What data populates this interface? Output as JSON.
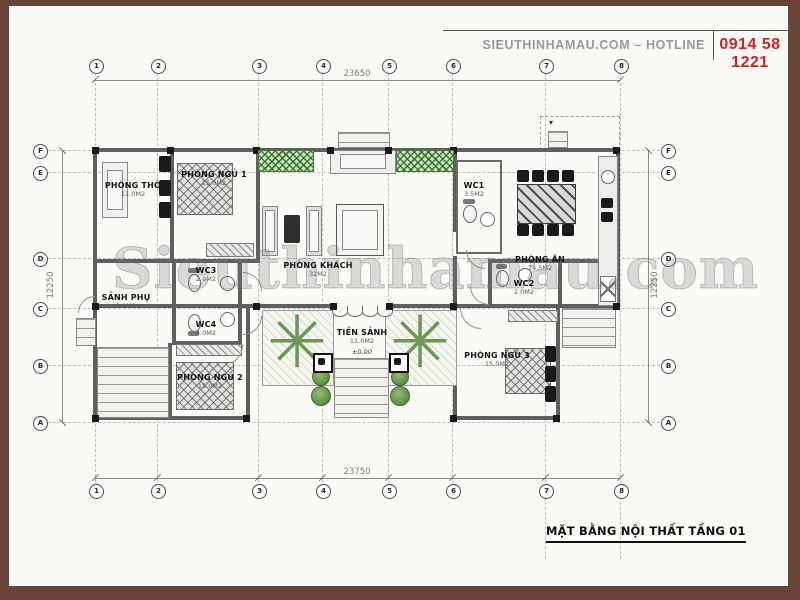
{
  "header": {
    "site": "SIEUTHINHAMAU.COM – HOTLINE",
    "phone": "0914 58 1221"
  },
  "title_block": {
    "drawing_title": "MẶT BẰNG NỘI THẤT TẦNG 01"
  },
  "watermark": "Sieuthinhamau.com",
  "dimensions": {
    "top": "23650",
    "bottom": "23750",
    "left": "12250",
    "right": "12250"
  },
  "grid": {
    "cols": [
      "1",
      "2",
      "3",
      "4",
      "5",
      "6",
      "7",
      "8"
    ],
    "rows": [
      "F",
      "E",
      "D",
      "C",
      "B",
      "A"
    ]
  },
  "rooms": [
    {
      "name": "PHÒNG THỜ",
      "area": "11.0M2"
    },
    {
      "name": "PHÒNG NGỦ 1",
      "area": "15.0M2"
    },
    {
      "name": "PHÒNG KHÁCH",
      "area": "32M2"
    },
    {
      "name": "WC1",
      "area": "3.5M2"
    },
    {
      "name": "PHÒNG ĂN",
      "area": "24.5M2"
    },
    {
      "name": "SẢNH PHỤ",
      "area": "9.0M2"
    },
    {
      "name": "WC3",
      "area": "2.0M2"
    },
    {
      "name": "WC4",
      "area": "4.0M2"
    },
    {
      "name": "TIỀN SẢNH",
      "area": "11.0M2"
    },
    {
      "name": "PHÒNG NGỦ 2",
      "area": "15.0M2"
    },
    {
      "name": "PHÒNG NGỦ 3",
      "area": "15.0M2"
    },
    {
      "name": "WC2",
      "area": "2.0M2"
    }
  ],
  "annotations": {
    "entry_level": "±0.00"
  },
  "icons": {
    "tree": "✳",
    "elevation_marker": "▾"
  },
  "colors": {
    "frame": "#6a443a",
    "phone": "#cc2127",
    "site_text": "#97999c",
    "wall": "#5f5f5f",
    "plant": "#4e8036"
  }
}
